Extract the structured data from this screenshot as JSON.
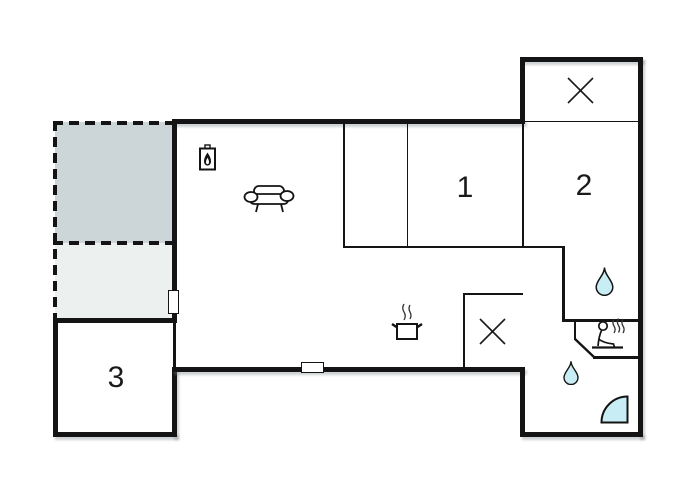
{
  "plan": {
    "type": "vacation-house-floor-plan",
    "room_labels": [
      {
        "id": "room-1",
        "label": "1"
      },
      {
        "id": "room-2",
        "label": "2"
      },
      {
        "id": "room-3",
        "label": "3"
      }
    ],
    "icons": [
      "cross-window-icon-annex",
      "fireplace-icon",
      "sofa-icon",
      "stove-pot-icon",
      "cross-window-icon-toilet",
      "water-drop-icon-wc",
      "sauna-icon",
      "water-drop-icon-bath",
      "shower-quarter-icon"
    ],
    "colors": {
      "walls": "#141414",
      "terrace_upper_fill": "#ccd6d8",
      "terrace_lower_fill": "#ecf1ef",
      "water_fill": "#c9edf4",
      "background": "#ffffff"
    }
  }
}
